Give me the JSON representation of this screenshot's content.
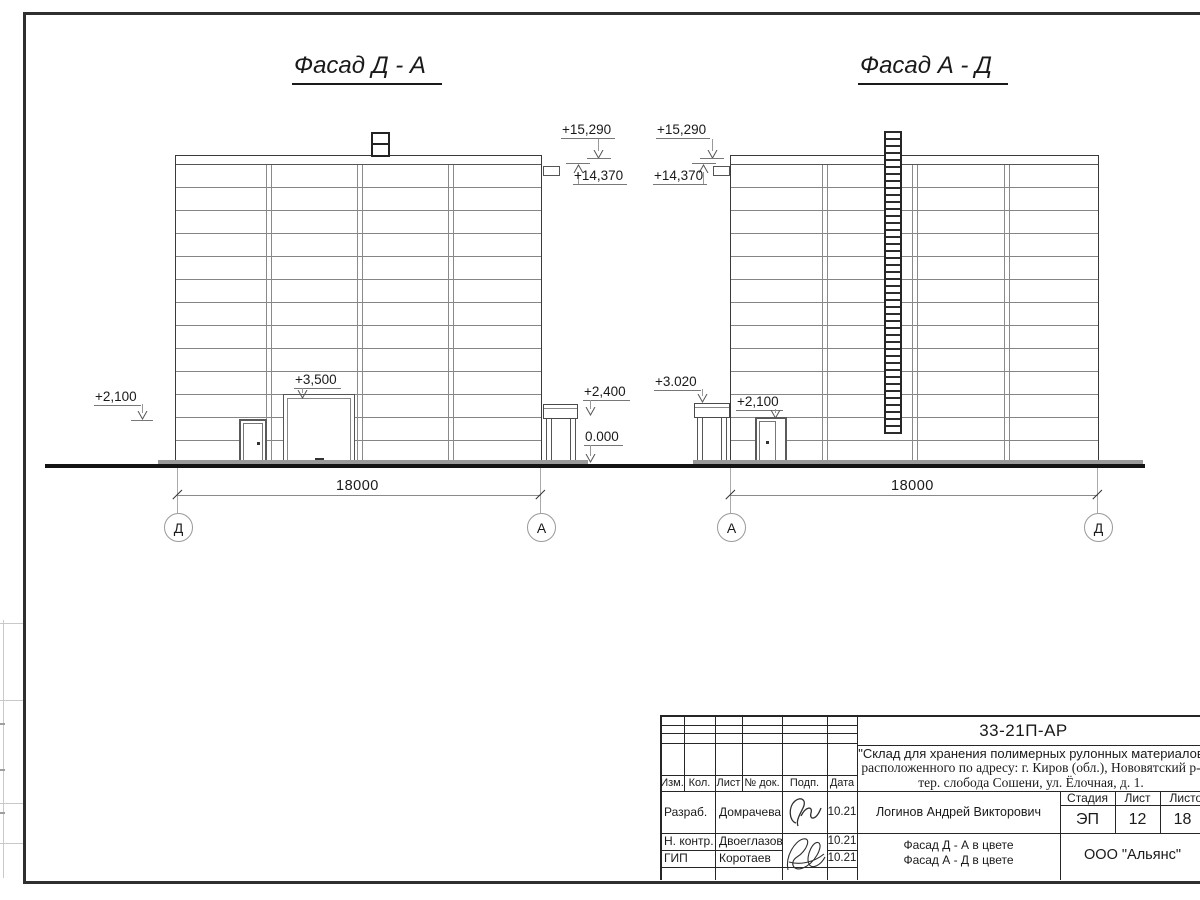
{
  "facades": {
    "left": {
      "title": "Фасад Д - А",
      "marks": {
        "m15290": "+15,290",
        "m14370": "+14,370",
        "gate": "+3,500",
        "wall": "+2,100",
        "canopy": "+2,400",
        "zero": "0.000"
      },
      "dimension": "18000",
      "axis_left": "Д",
      "axis_right": "А"
    },
    "right": {
      "title": "Фасад А - Д",
      "marks": {
        "m15290": "+15,290",
        "m14370": "+14,370",
        "canopy": "+3.020",
        "door": "+2,100"
      },
      "dimension": "18000",
      "axis_left": "А",
      "axis_right": "Д"
    }
  },
  "title_block": {
    "doc_number": "33-21П-АР",
    "project_line1": "\"Склад для хранения полимерных рулонных материалов",
    "project_line2": "расположенного по адресу: г. Киров (обл.), Нововятский р-",
    "project_line3": "тер. слобода Сошени, ул. Ёлочная, д. 1.",
    "rev_headers": {
      "izm": "Изм.",
      "kol": "Кол.",
      "list": "Лист",
      "doc": "№ док.",
      "podp": "Подп.",
      "data": "Дата"
    },
    "signers": [
      {
        "role": "Разраб.",
        "name": "Домрачева",
        "date": "10.21"
      },
      {
        "role": "Н. контр.",
        "name": "Двоеглазов",
        "date": "10.21"
      },
      {
        "role": "ГИП",
        "name": "Коротаев",
        "date": "10.21"
      }
    ],
    "approver": "Логинов Андрей Викторович",
    "stage_header": "Стадия",
    "sheet_header": "Лист",
    "sheets_header": "Листов",
    "stage": "ЭП",
    "sheet": "12",
    "sheets_total": "18",
    "sheet_name_line1": "Фасад Д - А в цвете",
    "sheet_name_line2": "Фасад А - Д в цвете",
    "company": "ООО \"Альянс\""
  }
}
